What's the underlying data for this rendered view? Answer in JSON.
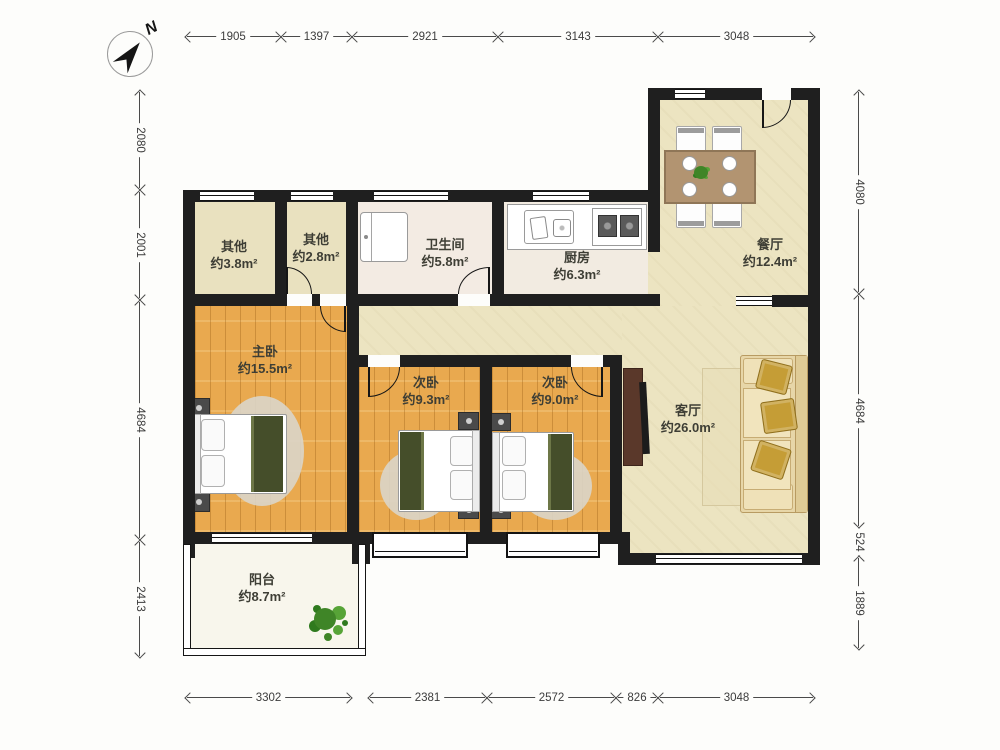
{
  "compass": {
    "north_label": "N"
  },
  "rooms": {
    "other1": {
      "name": "其他",
      "area": "约3.8m²"
    },
    "other2": {
      "name": "其他",
      "area": "约2.8m²"
    },
    "bathroom": {
      "name": "卫生间",
      "area": "约5.8m²"
    },
    "kitchen": {
      "name": "厨房",
      "area": "约6.3m²"
    },
    "dining": {
      "name": "餐厅",
      "area": "约12.4m²"
    },
    "master": {
      "name": "主卧",
      "area": "约15.5m²"
    },
    "bedroom2": {
      "name": "次卧",
      "area": "约9.3m²"
    },
    "bedroom3": {
      "name": "次卧",
      "area": "约9.0m²"
    },
    "living": {
      "name": "客厅",
      "area": "约26.0m²"
    },
    "balcony": {
      "name": "阳台",
      "area": "约8.7m²"
    }
  },
  "dimensions": {
    "top": [
      "1905",
      "1397",
      "2921",
      "3143",
      "3048"
    ],
    "left": [
      "2080",
      "2001",
      "4684",
      "2413"
    ],
    "right": [
      "4080",
      "4684",
      "524",
      "1889"
    ],
    "bottom": [
      "3302",
      "2381",
      "2572",
      "826",
      "3048"
    ]
  },
  "colors": {
    "wall": "#1f1f1f",
    "wood_floor": "#e9a94f",
    "tile_beige": "#ece4c1",
    "khaki_room": "#e9e1bf",
    "bath_floor": "#f3ebe3",
    "balcony_floor": "#f8f6ec",
    "blanket_green": "#454e2a",
    "sofa_beige": "#e7d6a8",
    "table_brown": "#b29471"
  }
}
